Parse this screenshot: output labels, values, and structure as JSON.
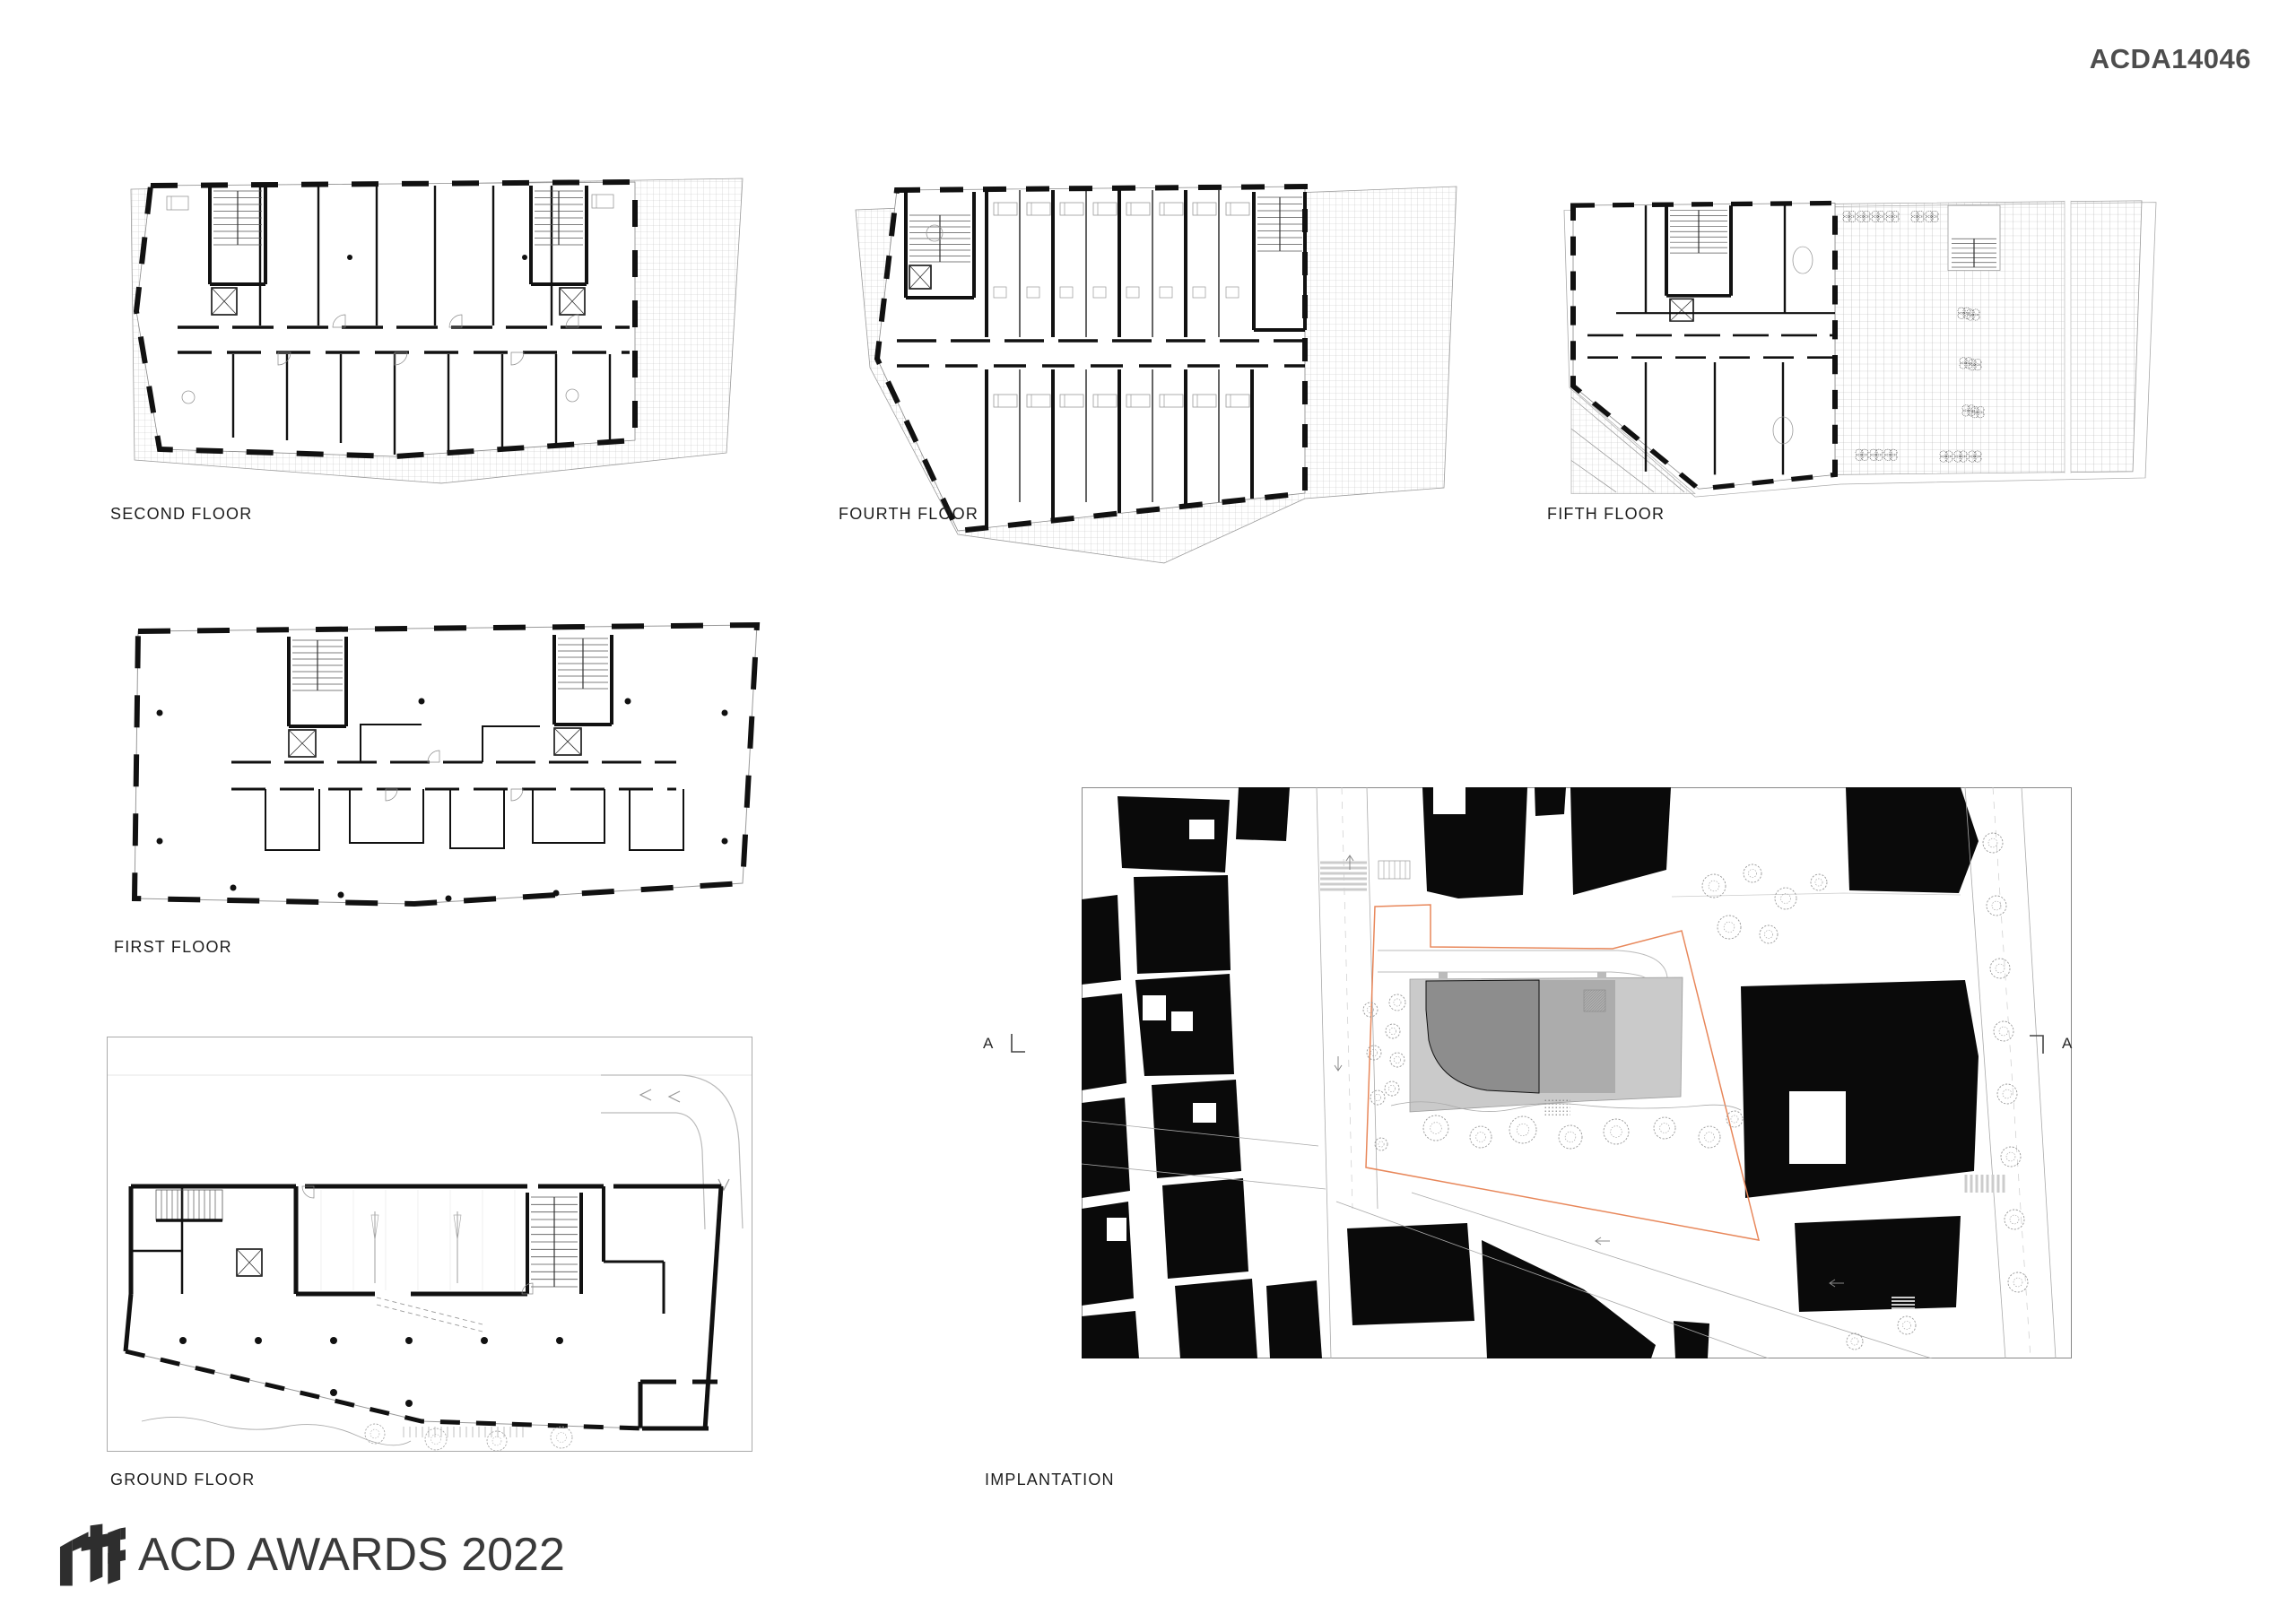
{
  "meta": {
    "code": "ACDA14046"
  },
  "plans": {
    "second": {
      "label": "SECOND FLOOR"
    },
    "fourth": {
      "label": "FOURTH FLOOR"
    },
    "fifth": {
      "label": "FIFTH FLOOR"
    },
    "first": {
      "label": "FIRST FLOOR"
    },
    "ground": {
      "label": "GROUND FLOOR"
    },
    "implantation": {
      "label": "IMPLANTATION"
    }
  },
  "section_markers": {
    "left": "A",
    "right": "A"
  },
  "logo": {
    "brand": "rtf",
    "title": "ACD AWARDS 2022"
  },
  "colors": {
    "wall": "#111111",
    "figure_ground": "#0a0a0a",
    "project_dark": "#8d8d8d",
    "project_mid": "#acacac",
    "project_light": "#cacaca",
    "parcel_line": "#e8875a",
    "label_text": "#1d1d1d",
    "code_text": "#4d4d4d",
    "logo_text": "#3a3a3a"
  }
}
